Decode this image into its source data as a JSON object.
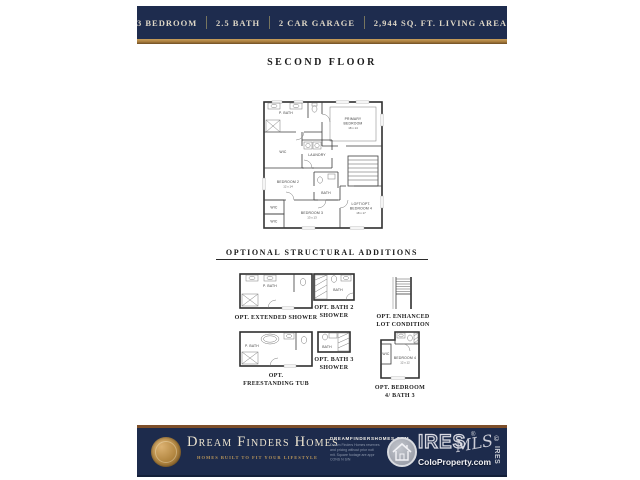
{
  "banner": {
    "specs": [
      "3 BEDROOM",
      "2.5 BATH",
      "2 CAR GARAGE",
      "2,944 SQ. FT. LIVING AREA"
    ]
  },
  "sections": {
    "floor_title": "SECOND FLOOR",
    "options_title": "OPTIONAL STRUCTURAL ADDITIONS"
  },
  "floor_plan": {
    "p_bath": "P. BATH",
    "wic_primary": "WIC",
    "laundry": "LAUNDRY",
    "primary_line1": "PRIMARY",
    "primary_line2": "BEDROOM",
    "primary_dim": "18 x 14",
    "bedroom2": "BEDROOM 2",
    "bedroom2_dim": "12 x 14",
    "bath2": "BATH",
    "bedroom3": "BEDROOM 3",
    "bedroom3_dim": "13 x 13",
    "loft_line1": "LOFT/OPT.",
    "loft_line2": "BEDROOM 4",
    "loft_dim": "18 x 17",
    "wic_a": "WIC",
    "wic_b": "WIC"
  },
  "options": [
    {
      "caption": "OPT. EXTENDED SHOWER",
      "label": "P. BATH"
    },
    {
      "caption": "OPT. BATH 2 SHOWER",
      "label": "BATH"
    },
    {
      "caption": "OPT. ENHANCED LOT CONDITION",
      "label": ""
    },
    {
      "caption": "OPT. FREESTANDING TUB",
      "label": "P. BATH"
    },
    {
      "caption": "OPT. BATH 3 SHOWER",
      "label": "BATH"
    },
    {
      "caption": "OPT. BEDROOM 4/ BATH 3",
      "label": "BEDROOM 4",
      "dim": "12 x 12",
      "wic": "WIC"
    }
  ],
  "footer": {
    "brand": "Dream Finders Homes",
    "tagline": "HOMES BUILT TO FIT YOUR LIFESTYLE",
    "website": "DREAMFINDERSHOMES.COM",
    "disclaimer": [
      "Dream Finders Homes reserves",
      "and pricing without prior noti",
      "mit. Square footage are appr",
      "CONS N S/N"
    ],
    "ires": {
      "name": "IRES",
      "mls": "MLS",
      "colo": "ColoProperty.com",
      "reg": "®",
      "copyright": "© IRES"
    }
  },
  "colors": {
    "navy": "#1e2c4e",
    "gold": "#a87c3c",
    "cream": "#ece4d0"
  }
}
